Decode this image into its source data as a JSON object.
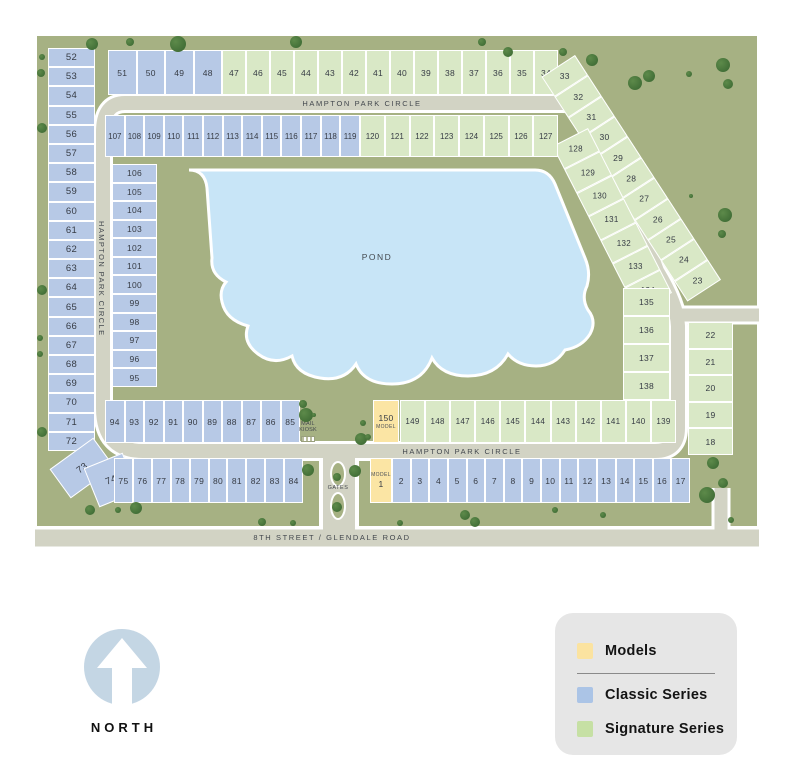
{
  "map": {
    "streets": {
      "hampton_park_circle_top": "HAMPTON PARK CIRCLE",
      "hampton_park_circle_left": "HAMPTON PARK CIRCLE",
      "hampton_park_circle_bottom": "HAMPTON PARK CIRCLE",
      "eighth_street": "8TH STREET / GLENDALE ROAD"
    },
    "labels": {
      "pond": "POND",
      "mail_kiosk": "MAIL KIOSK",
      "gates": "GATES",
      "model": "MODEL"
    },
    "lots": {
      "left_outer_column": [
        "52",
        "53",
        "54",
        "55",
        "56",
        "57",
        "58",
        "59",
        "60",
        "61",
        "62",
        "63",
        "64",
        "65",
        "66",
        "67",
        "68",
        "69",
        "70",
        "71",
        "72"
      ],
      "lot_73": "73",
      "lot_74": "74",
      "top_row_classic": [
        "51",
        "50",
        "49",
        "48"
      ],
      "top_row_signature": [
        "47",
        "46",
        "45",
        "44",
        "43",
        "42",
        "41",
        "40",
        "39",
        "38",
        "37",
        "36",
        "35",
        "34"
      ],
      "outer_curve": [
        "33",
        "32",
        "31",
        "30",
        "29",
        "28",
        "27",
        "26",
        "25",
        "24",
        "23"
      ],
      "right_column": [
        "22",
        "21",
        "20",
        "19",
        "18"
      ],
      "row2_classic": [
        "107",
        "108",
        "109",
        "110",
        "111",
        "112",
        "113",
        "114",
        "115",
        "116",
        "117",
        "118",
        "119"
      ],
      "row2_signature": [
        "120",
        "121",
        "122",
        "123",
        "124",
        "125",
        "126",
        "127"
      ],
      "inner_curve": [
        "128",
        "129",
        "130",
        "131",
        "132",
        "133",
        "134"
      ],
      "inner_right_column": [
        "135",
        "136",
        "137",
        "138"
      ],
      "left_inner_column": [
        "106",
        "105",
        "104",
        "103",
        "102",
        "101",
        "100",
        "99",
        "98",
        "97",
        "96",
        "95"
      ],
      "mid_row_classic": [
        "94",
        "93",
        "92",
        "91",
        "90",
        "89",
        "88",
        "87",
        "86",
        "85"
      ],
      "model_150": "150",
      "mid_row_signature": [
        "149",
        "148",
        "147",
        "146",
        "145",
        "144",
        "143",
        "142",
        "141",
        "140",
        "139"
      ],
      "bottom_row_classic_left": [
        "75",
        "76",
        "77",
        "78",
        "79",
        "80",
        "81",
        "82",
        "83",
        "84"
      ],
      "model_1": "1",
      "bottom_row_classic_right": [
        "2",
        "3",
        "4",
        "5",
        "6",
        "7",
        "8",
        "9",
        "10",
        "11",
        "12",
        "13",
        "14",
        "15",
        "16",
        "17"
      ]
    }
  },
  "legend": {
    "items": [
      {
        "label": "Models",
        "color": "#fbe3a0"
      },
      {
        "label": "Classic Series",
        "color": "#abc4e6"
      },
      {
        "label": "Signature Series",
        "color": "#c6e0a4"
      }
    ]
  },
  "compass": {
    "label": "NORTH"
  },
  "colors": {
    "classic_lot": "#b7c9e6",
    "signature_lot": "#d9e8c6",
    "model_lot": "#fbe5a4",
    "pond": "#c8e5f7",
    "road": "#d2d3c4",
    "map_background": "#a6b183"
  }
}
